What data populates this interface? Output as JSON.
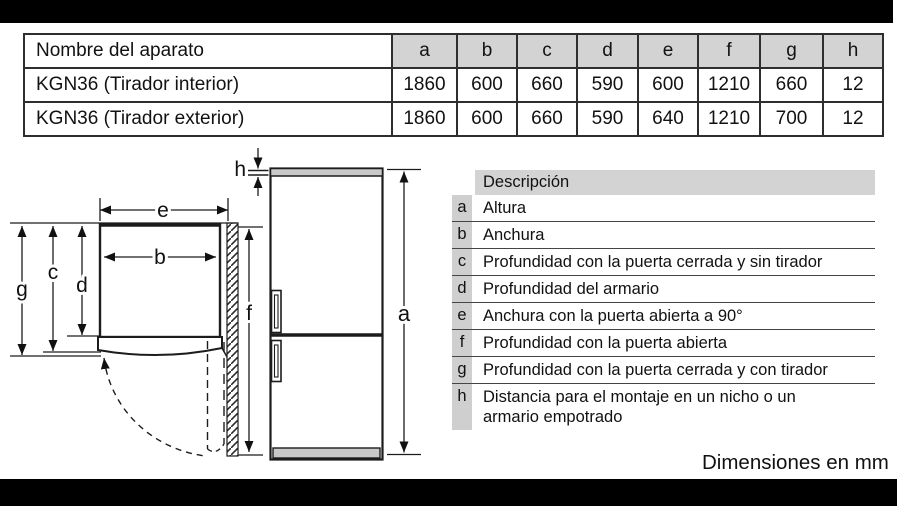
{
  "top_table": {
    "name_header": "Nombre del aparato",
    "dim_headers": [
      "a",
      "b",
      "c",
      "d",
      "e",
      "f",
      "g",
      "h"
    ],
    "rows": [
      {
        "name": "KGN36 (Tirador interior)",
        "values": [
          "1860",
          "600",
          "660",
          "590",
          "600",
          "1210",
          "660",
          "12"
        ]
      },
      {
        "name": "KGN36 (Tirador exterior)",
        "values": [
          "1860",
          "600",
          "660",
          "590",
          "640",
          "1210",
          "700",
          "12"
        ]
      }
    ]
  },
  "description_table": {
    "header": "Descripción",
    "rows": [
      {
        "key": "a",
        "text": "Altura"
      },
      {
        "key": "b",
        "text": "Anchura"
      },
      {
        "key": "c",
        "text": "Profundidad con la puerta cerrada y sin tirador"
      },
      {
        "key": "d",
        "text": "Profundidad del armario"
      },
      {
        "key": "e",
        "text": "Anchura con la puerta abierta a 90°"
      },
      {
        "key": "f",
        "text": "Profundidad con la puerta abierta"
      },
      {
        "key": "g",
        "text": "Profundidad con la puerta cerrada y con tirador"
      },
      {
        "key": "h",
        "text": "Distancia para el montaje en un nicho o un armario empotrado"
      }
    ]
  },
  "diagram": {
    "labels": {
      "a": "a",
      "b": "b",
      "c": "c",
      "d": "d",
      "e": "e",
      "f": "f",
      "g": "g",
      "h": "h"
    }
  },
  "footer": {
    "units_note": "Dimensiones en mm"
  },
  "colors": {
    "header_gray": "#d3d3d3",
    "fridge_gray": "#c9c9c9",
    "line": "#1c1c1c",
    "band_black": "#000000"
  }
}
